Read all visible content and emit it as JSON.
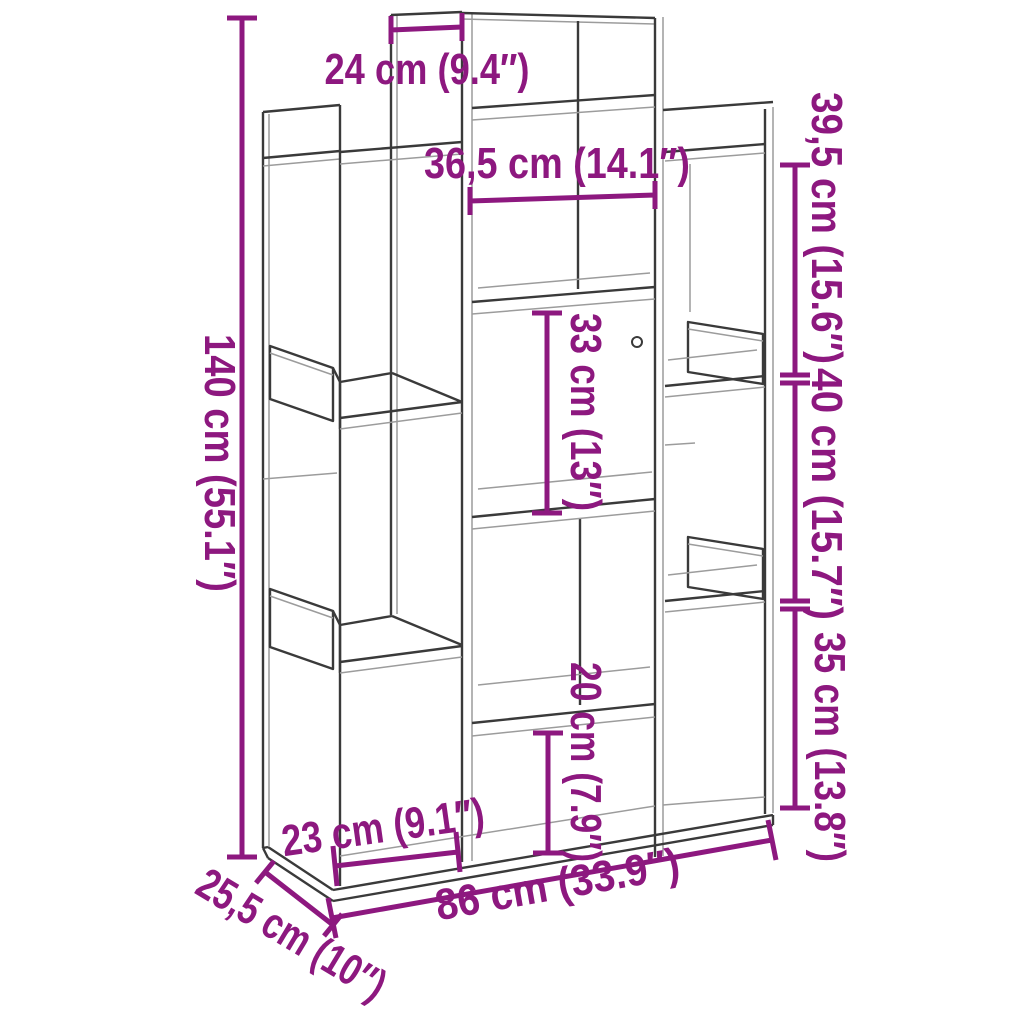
{
  "diagram": {
    "kind": "furniture-dimension-diagram",
    "colors": {
      "dimension": "#8d187f",
      "outline": "#3a3a3a",
      "outline_light": "#9c9c9c",
      "background": "#ffffff"
    },
    "dims": {
      "top_cubby": {
        "label": "24 cm (9.4″)"
      },
      "inner_width": {
        "label": "36,5 cm (14.1″)"
      },
      "right_top": {
        "label": "39,5 cm (15.6″)"
      },
      "right_mid": {
        "label": "40 cm (15.7″)"
      },
      "right_low": {
        "label": "35 cm (13.8″)"
      },
      "total_height": {
        "label": "140 cm (55.1″)"
      },
      "center_upper": {
        "label": "33 cm (13″)"
      },
      "center_lower": {
        "label": "20 cm (7.9″)"
      },
      "bottom_left": {
        "label": "23 cm (9.1″)"
      },
      "depth": {
        "label": "25,5 cm (10″)"
      },
      "total_width": {
        "label": "86 cm (33.9″)"
      }
    }
  }
}
